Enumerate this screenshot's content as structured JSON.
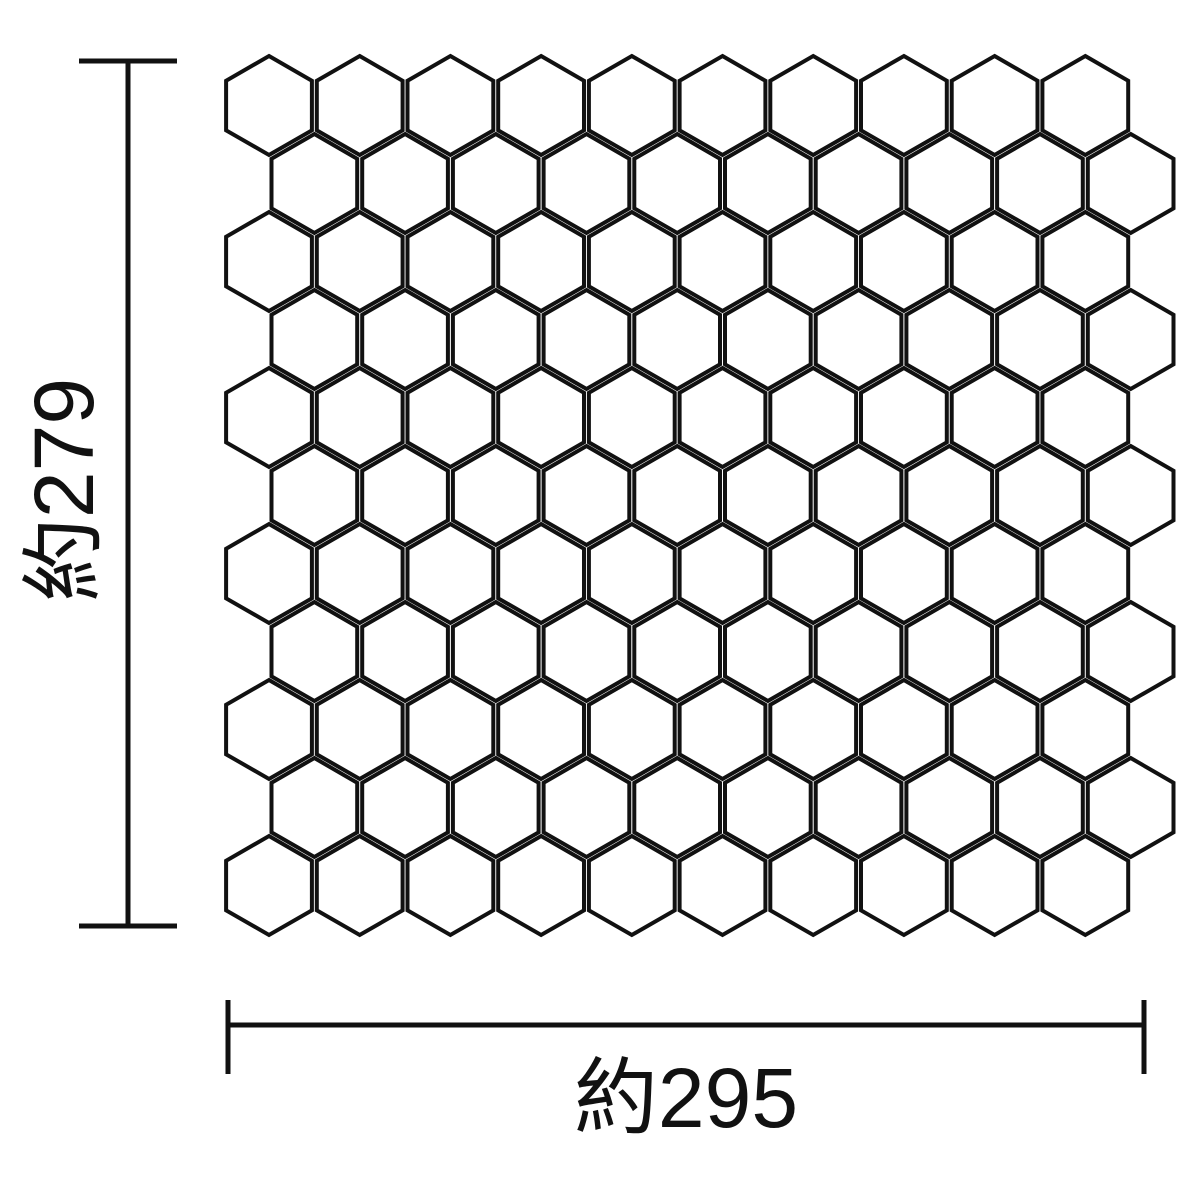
{
  "diagram": {
    "background_color": "#ffffff",
    "line_color": "#111111",
    "dimension_height": {
      "label": "約279",
      "orientation": "vertical"
    },
    "dimension_width": {
      "label": "約295",
      "orientation": "horizontal"
    },
    "mosaic_grid": {
      "tile_shape": "hexagon",
      "rows": 11,
      "columns_per_row": 10,
      "tile_total": 110
    }
  }
}
